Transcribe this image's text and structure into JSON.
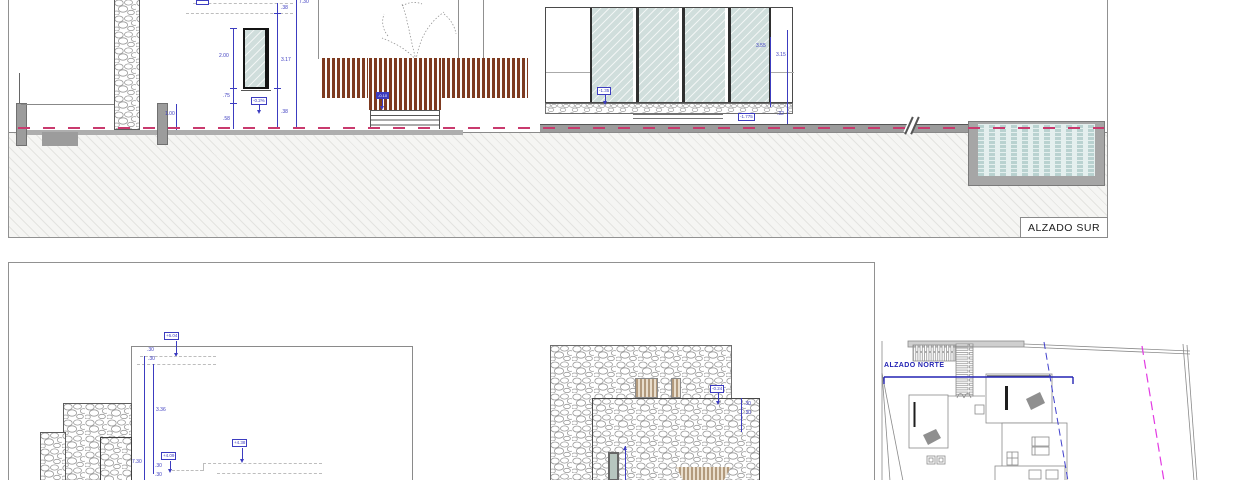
{
  "sheet": {
    "south": {
      "title": "ALZADO SUR",
      "dims": {
        "fence_height": "1.00",
        "roof_edge": ".38",
        "window_height": "2.00",
        "window_sill": ".75",
        "plinth": ".58",
        "opening_total": "3.17",
        "base_band": ".38",
        "wall_total": "7.30",
        "pavilion_clear": "3.55",
        "pavilion_total": "3.15",
        "pavilion_base": ".32"
      },
      "levels": {
        "terrace_slope": "-0.2%",
        "deck": "-0.10",
        "pavilion_floor": "-1.35",
        "pool_deck": "-1.775"
      }
    },
    "north": {
      "title": "ALZADO NORTE",
      "levels": {
        "roof_main": "+6.04",
        "roof_low": "+4.09",
        "roof_mid": "+4.38",
        "parapet": "-0.24"
      },
      "dims": {
        "cap_a": ".30",
        "cap_b": ".30",
        "upper_wall": "3.36",
        "wall_total": "7.30",
        "step_a": ".30",
        "step_b": ".30",
        "chimney_a": ".30",
        "chimney_b": ".30"
      }
    }
  }
}
